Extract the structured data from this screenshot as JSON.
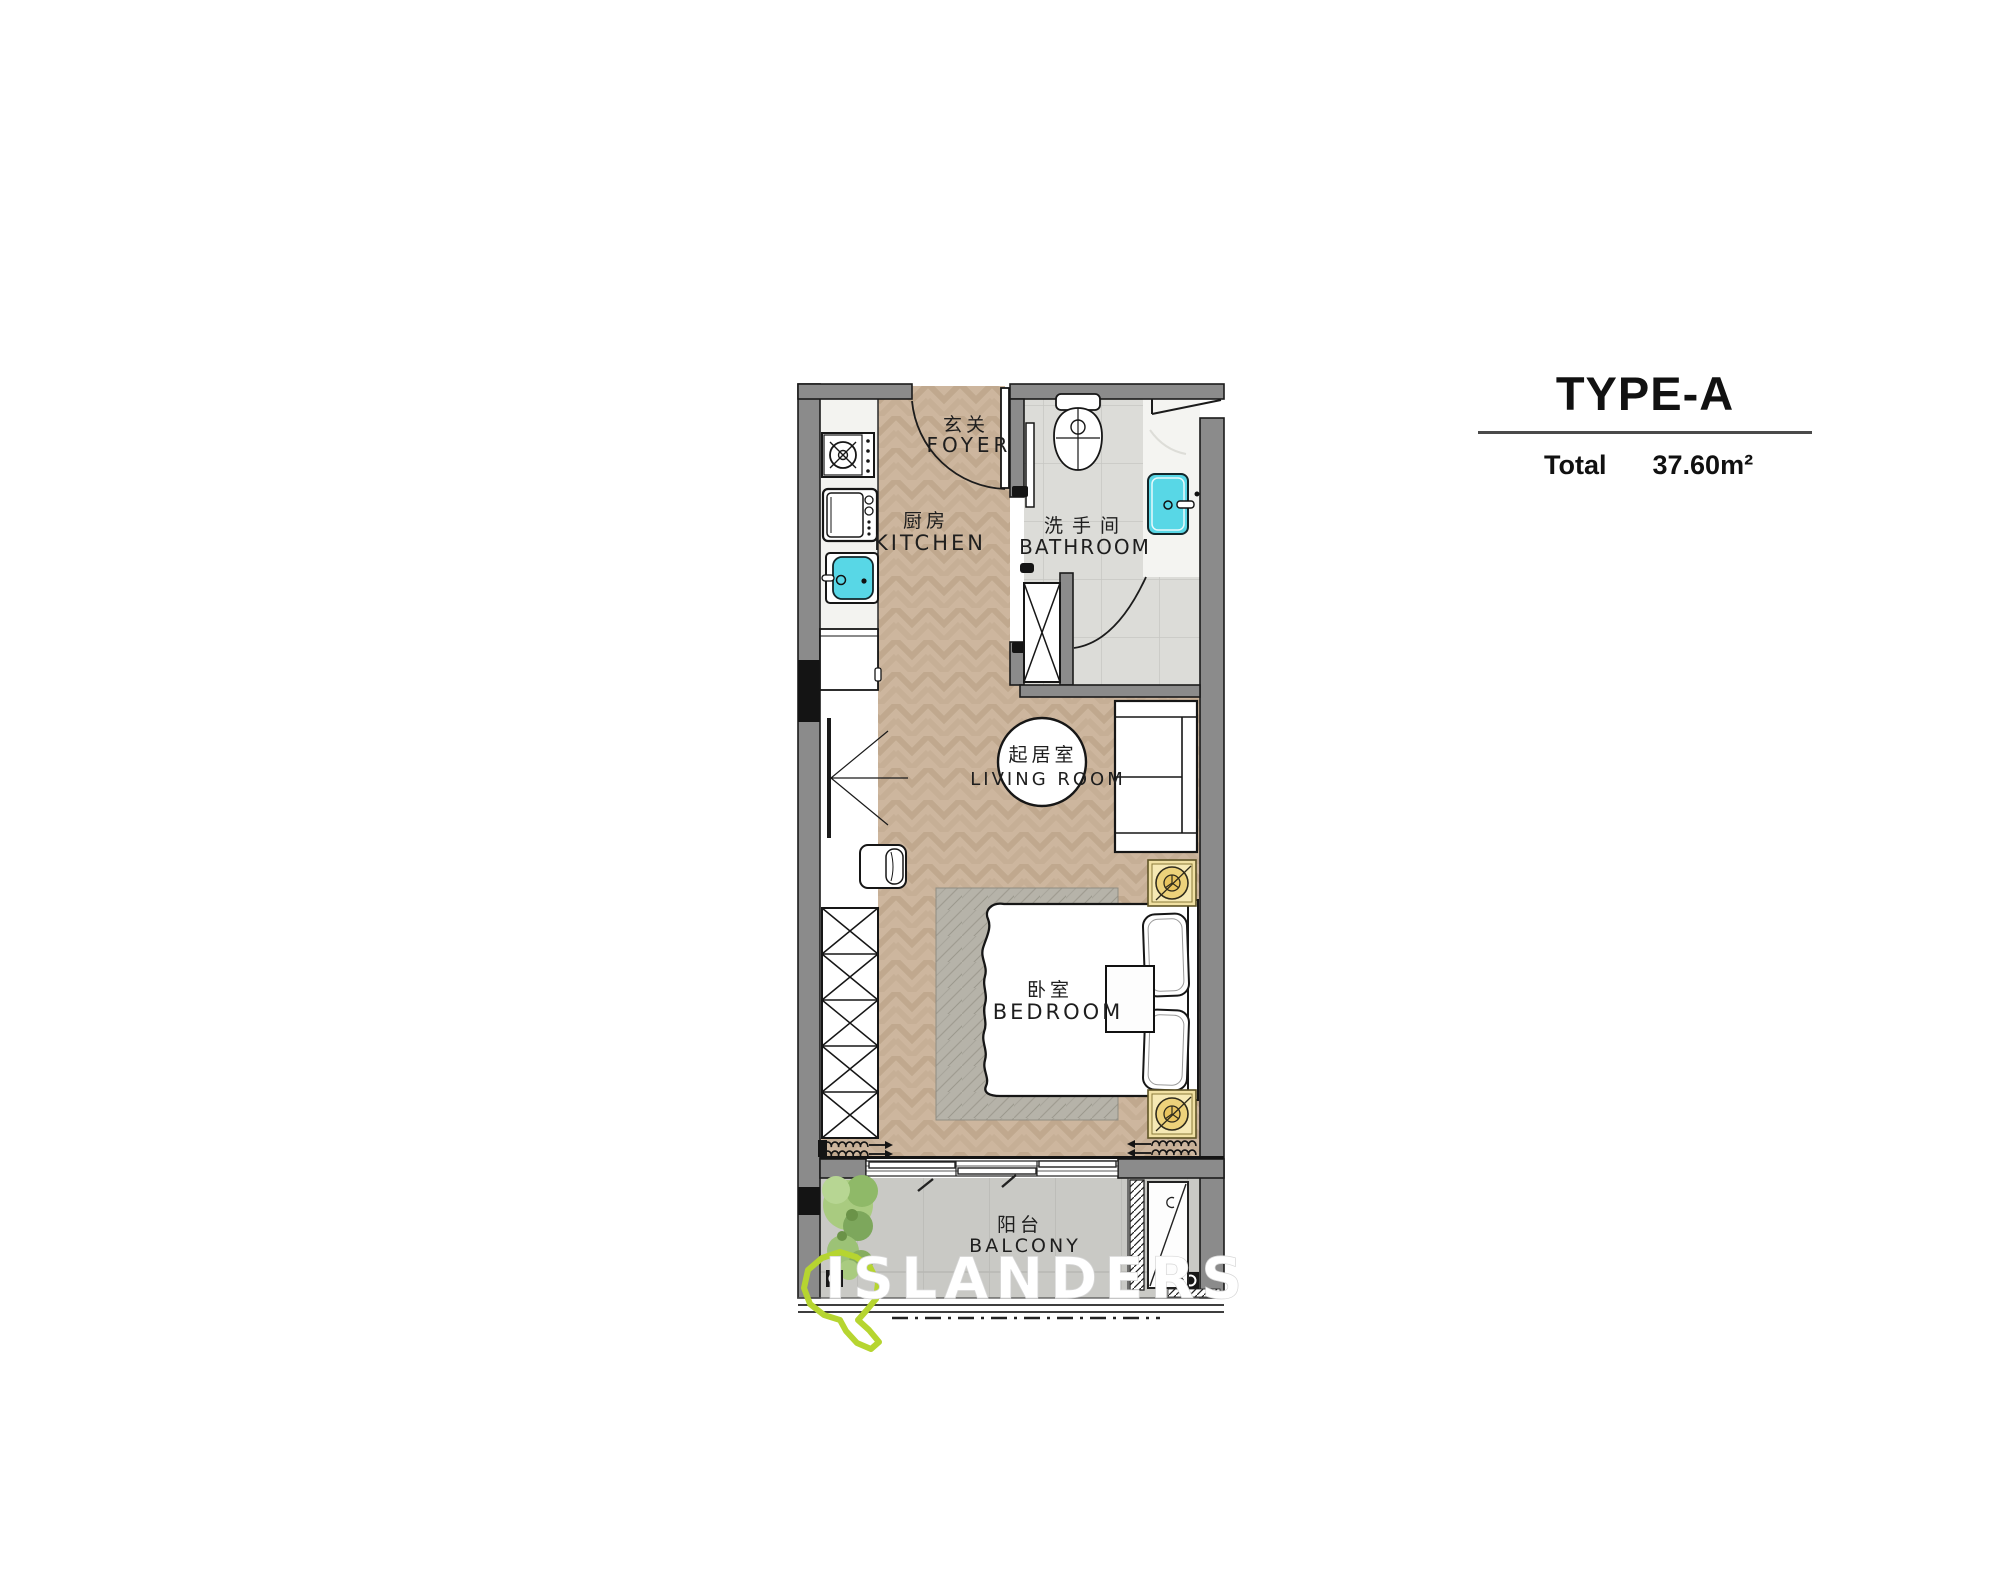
{
  "title_block": {
    "type": "TYPE-A",
    "total_label": "Total",
    "area_value": "37.60m²"
  },
  "rooms": {
    "foyer": {
      "zh": "玄关",
      "en": "FOYER"
    },
    "kitchen": {
      "zh": "厨房",
      "en": "KITCHEN"
    },
    "bathroom": {
      "zh": "洗手间",
      "en": "BATHROOM"
    },
    "living_room": {
      "zh": "起居室",
      "en": "LIVING ROOM"
    },
    "bedroom": {
      "zh": "卧室",
      "en": "BEDROOM"
    },
    "balcony": {
      "zh": "阳台",
      "en": "BALCONY"
    }
  },
  "watermark": {
    "brand": "ISLANDERS",
    "logo_color": "#b6d530"
  },
  "palette": {
    "wall": "#8b8b8b",
    "wall_outline": "#1b1b1b",
    "wood": "#cdb69e",
    "bath_tile": "#dcdcd8",
    "balcony_tile": "#c9c9c5",
    "rug": "#b6b3a9",
    "fixture_cyan": "#58d7e6",
    "lamp_gold": "#f0e0a2",
    "marble": "#f4f4f1"
  }
}
